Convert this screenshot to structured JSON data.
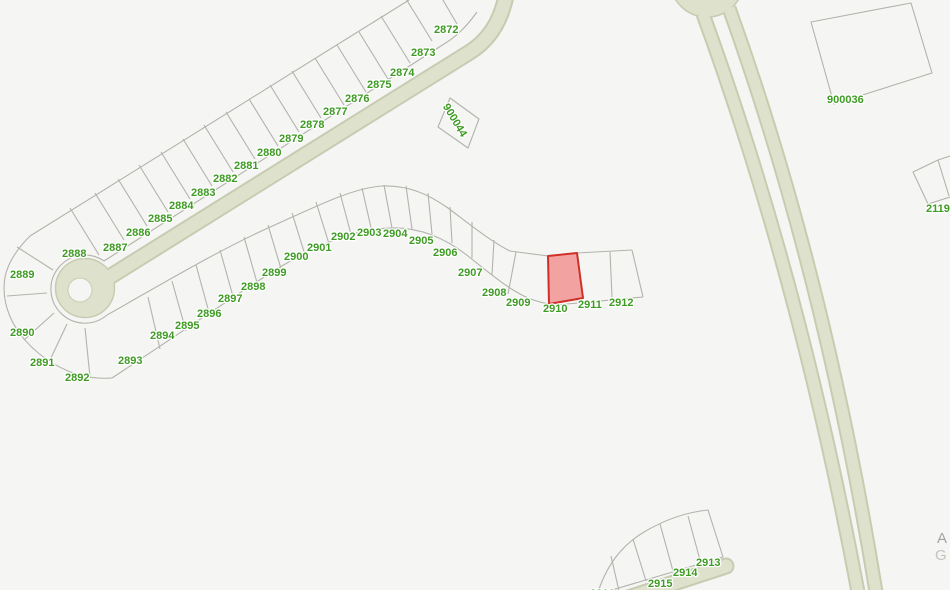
{
  "map": {
    "background": "#f5f5f4",
    "colors": {
      "parcel_line": "#b3b3ab",
      "road_fill": "#dee1cc",
      "road_casing": "#c7ccb1",
      "label_green": "#3e9b23",
      "highlight_fill": "#f2a2a0",
      "highlight_stroke": "#cf3028"
    },
    "highlight_parcel": {
      "id": "2910",
      "d": "M 548,256 L 577,253 L 583,298 L 549,304 Z"
    },
    "roads": [
      {
        "name": "entry-street",
        "d": "M 507,-10 C 503,16 492,38 470,52 L 95,286",
        "casing": 17,
        "width": 13,
        "cap": "butt"
      },
      {
        "name": "boulevard-west",
        "d": "M 703,14 Q 800,280 858,592",
        "casing": 15,
        "width": 11,
        "cap": "butt"
      },
      {
        "name": "boulevard-east",
        "d": "M 729,8 Q 824,272 876,592",
        "casing": 15,
        "width": 11,
        "cap": "butt"
      },
      {
        "name": "south-street",
        "d": "M 628,598 L 726,566",
        "casing": 17,
        "width": 13,
        "cap": "round"
      }
    ],
    "discs": [
      {
        "name": "cul-de-sac",
        "cx": 85,
        "cy": 288,
        "r": 29.5,
        "hole_cx": 80,
        "hole_cy": 290,
        "hole_r": 12
      },
      {
        "name": "roundabout",
        "cx": 707,
        "cy": -20,
        "r": 37,
        "hole_cx": 707,
        "hole_cy": -19,
        "hole_r": 17
      }
    ],
    "parcel_paths": [
      "M 477,12 C 464,30 454,38 444,44 L 104,261",
      "M 409,0 L 30,236",
      "M 30,236 C 18,248 8,262 5,277 C 2,294 6,312 16,328 C 28,347 47,362 68,371 C 82,377 97,379 112,378",
      "M 104,261 A 34,34 0 1 0 107,315",
      "M 457,24 L 430,-22",
      "M 432,41 L 403,-6",
      "M 410,63 L 381,16",
      "M 388,79 L 359,32",
      "M 366,92 L 337,45",
      "M 344,105 L 315,58",
      "M 321,118 L 292,71",
      "M 299,132 L 270,85",
      "M 278,146 L 249,99",
      "M 255,159 L 226,112",
      "M 233,172 L 204,125",
      "M 212,186 L 183,139",
      "M 190,199 L 161,152",
      "M 168,212 L 139,165",
      "M 147,226 L 118,179",
      "M 124,240 L 95,193",
      "M 99,255 L 70,208",
      "M 53,270 L 17,247",
      "M 47,293 L 7,296",
      "M 54,313 L 24,340",
      "M 67,324 L 50,360",
      "M 85,328 L 90,377",
      "M 107,315 C 155,288 215,252 268,228 C 315,207 352,188 382,186 C 408,185 428,194 448,208 C 468,223 490,241 510,251 L 548,256 L 577,253 L 632,250",
      "M 112,378 C 170,340 225,302 272,272 C 315,245 355,229 390,228 C 420,227 445,238 468,256 C 488,272 508,289 528,298 C 538,302 546,304 556,305 L 643,297",
      "M 632,250 L 643,297",
      "M 148,297 L 160,349",
      "M 172,281 L 186,331",
      "M 196,265 L 210,316",
      "M 220,250 L 234,300",
      "M 244,237 L 258,286",
      "M 268,225 L 282,272",
      "M 292,213 L 306,258",
      "M 316,202 L 330,247",
      "M 340,193 L 352,238",
      "M 362,188 L 372,232",
      "M 384,185 L 392,228",
      "M 406,186 L 412,229",
      "M 428,193 L 432,234",
      "M 450,207 L 452,243",
      "M 472,222 L 472,258",
      "M 494,240 L 492,275",
      "M 516,252 L 508,294",
      "M 577,253 L 583,298",
      "M 610,252 L 612,297",
      "M 598,592 C 608,562 624,544 644,532 C 666,519 688,512 708,510 L 723,557 L 612,590",
      "M 688,516 L 700,560",
      "M 660,524 L 673,571",
      "M 633,539 L 646,581",
      "M 611,556 L 619,591",
      "M 450,98 L 479,119 L 468,148 L 438,127 Z",
      "M 811,22 L 911,3 L 932,73 L 834,104 Z",
      "M 950,156 L 938,160 L 913,172 L 928,204 L 950,197 M 938,160 L 949,196"
    ],
    "parcel_labels": [
      {
        "text": "2872",
        "x": 434,
        "y": 33
      },
      {
        "text": "2873",
        "x": 411,
        "y": 56
      },
      {
        "text": "2874",
        "x": 390,
        "y": 76
      },
      {
        "text": "2875",
        "x": 367,
        "y": 88
      },
      {
        "text": "2876",
        "x": 345,
        "y": 102
      },
      {
        "text": "2877",
        "x": 323,
        "y": 115
      },
      {
        "text": "2878",
        "x": 300,
        "y": 128
      },
      {
        "text": "2879",
        "x": 279,
        "y": 142
      },
      {
        "text": "2880",
        "x": 257,
        "y": 156
      },
      {
        "text": "2881",
        "x": 234,
        "y": 169
      },
      {
        "text": "2882",
        "x": 213,
        "y": 182
      },
      {
        "text": "2883",
        "x": 191,
        "y": 196
      },
      {
        "text": "2884",
        "x": 169,
        "y": 209
      },
      {
        "text": "2885",
        "x": 148,
        "y": 222
      },
      {
        "text": "2886",
        "x": 126,
        "y": 236
      },
      {
        "text": "2887",
        "x": 103,
        "y": 251
      },
      {
        "text": "2888",
        "x": 62,
        "y": 257
      },
      {
        "text": "2889",
        "x": 10,
        "y": 278
      },
      {
        "text": "2890",
        "x": 10,
        "y": 336
      },
      {
        "text": "2891",
        "x": 30,
        "y": 366
      },
      {
        "text": "2892",
        "x": 65,
        "y": 381
      },
      {
        "text": "2893",
        "x": 118,
        "y": 364
      },
      {
        "text": "2894",
        "x": 150,
        "y": 339
      },
      {
        "text": "2895",
        "x": 175,
        "y": 329
      },
      {
        "text": "2896",
        "x": 197,
        "y": 317
      },
      {
        "text": "2897",
        "x": 218,
        "y": 302
      },
      {
        "text": "2898",
        "x": 241,
        "y": 290
      },
      {
        "text": "2899",
        "x": 262,
        "y": 276
      },
      {
        "text": "2900",
        "x": 284,
        "y": 260
      },
      {
        "text": "2901",
        "x": 307,
        "y": 251
      },
      {
        "text": "2902",
        "x": 331,
        "y": 240
      },
      {
        "text": "2903",
        "x": 357,
        "y": 236
      },
      {
        "text": "2904",
        "x": 383,
        "y": 237
      },
      {
        "text": "2905",
        "x": 409,
        "y": 244
      },
      {
        "text": "2906",
        "x": 433,
        "y": 256
      },
      {
        "text": "2907",
        "x": 458,
        "y": 276
      },
      {
        "text": "2908",
        "x": 482,
        "y": 296
      },
      {
        "text": "2909",
        "x": 506,
        "y": 306
      },
      {
        "text": "2910",
        "x": 543,
        "y": 312
      },
      {
        "text": "2911",
        "x": 578,
        "y": 308
      },
      {
        "text": "2912",
        "x": 609,
        "y": 306
      },
      {
        "text": "2913",
        "x": 696,
        "y": 566
      },
      {
        "text": "2914",
        "x": 673,
        "y": 576
      },
      {
        "text": "2915",
        "x": 648,
        "y": 587
      },
      {
        "text": "2916",
        "x": 590,
        "y": 597
      },
      {
        "text": "900044",
        "x": 452,
        "y": 122,
        "rot": 59,
        "anchor": "middle"
      },
      {
        "text": "900036",
        "x": 827,
        "y": 103
      },
      {
        "text": "2119",
        "x": 926,
        "y": 212
      }
    ],
    "street_labels": [
      {
        "text": "A",
        "x": 937,
        "y": 543,
        "color": "#a3a3a1"
      },
      {
        "text": "G",
        "x": 935,
        "y": 560,
        "color": "#c3c3bf"
      }
    ]
  }
}
